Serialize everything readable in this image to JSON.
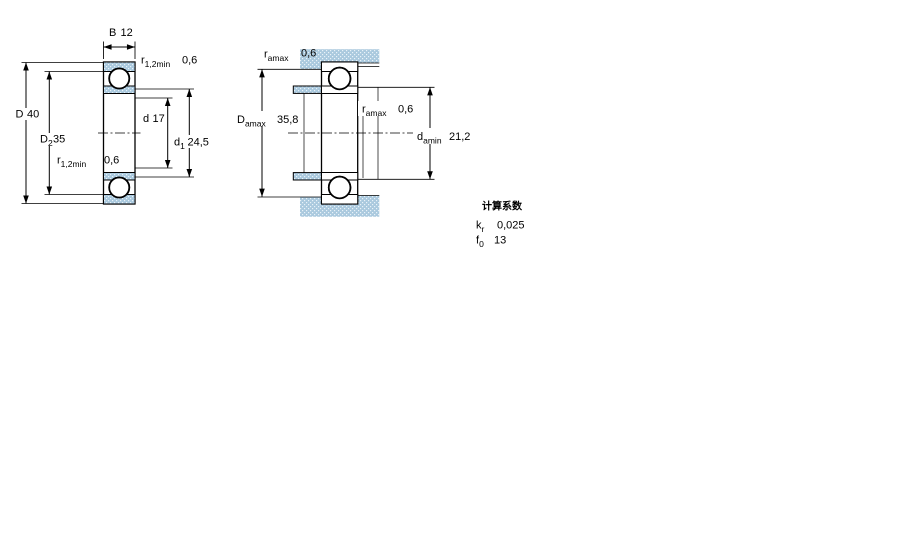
{
  "figure": {
    "colors": {
      "section_fill": "#aac9de",
      "line": "#000000"
    },
    "left_view": {
      "width_dim": {
        "symbol": "B",
        "value": "12"
      },
      "outer_dia_dim": {
        "symbol": "D",
        "value": "40"
      },
      "outer_shoulder_dim": {
        "symbol": "D",
        "sub": "2",
        "value": "35"
      },
      "bore_dim": {
        "symbol": "d",
        "value": "17"
      },
      "inner_shoulder_dim": {
        "symbol": "d",
        "sub": "1",
        "value": "24,5"
      },
      "fillet_top": {
        "symbol": "r",
        "sub": "1,2min",
        "value": "0,6"
      },
      "fillet_bottom": {
        "symbol": "r",
        "sub": "1,2min",
        "value": "0,6"
      }
    },
    "right_view": {
      "abutment_fillet_top": {
        "symbol": "r",
        "sub": "amax",
        "value": "0,6"
      },
      "abutment_fillet_mid": {
        "symbol": "r",
        "sub": "amax",
        "value": "0,6"
      },
      "housing_abutment_dim": {
        "symbol": "D",
        "sub": "amax",
        "value": "35,8"
      },
      "shaft_abutment_dim": {
        "symbol": "d",
        "sub": "amin",
        "value": "21,2"
      }
    },
    "calculation_factors": {
      "title": "计算系数",
      "rows": [
        {
          "symbol": "k",
          "sub": "r",
          "value": "0,025"
        },
        {
          "symbol": "f",
          "sub": "0",
          "value": "13"
        }
      ]
    }
  }
}
